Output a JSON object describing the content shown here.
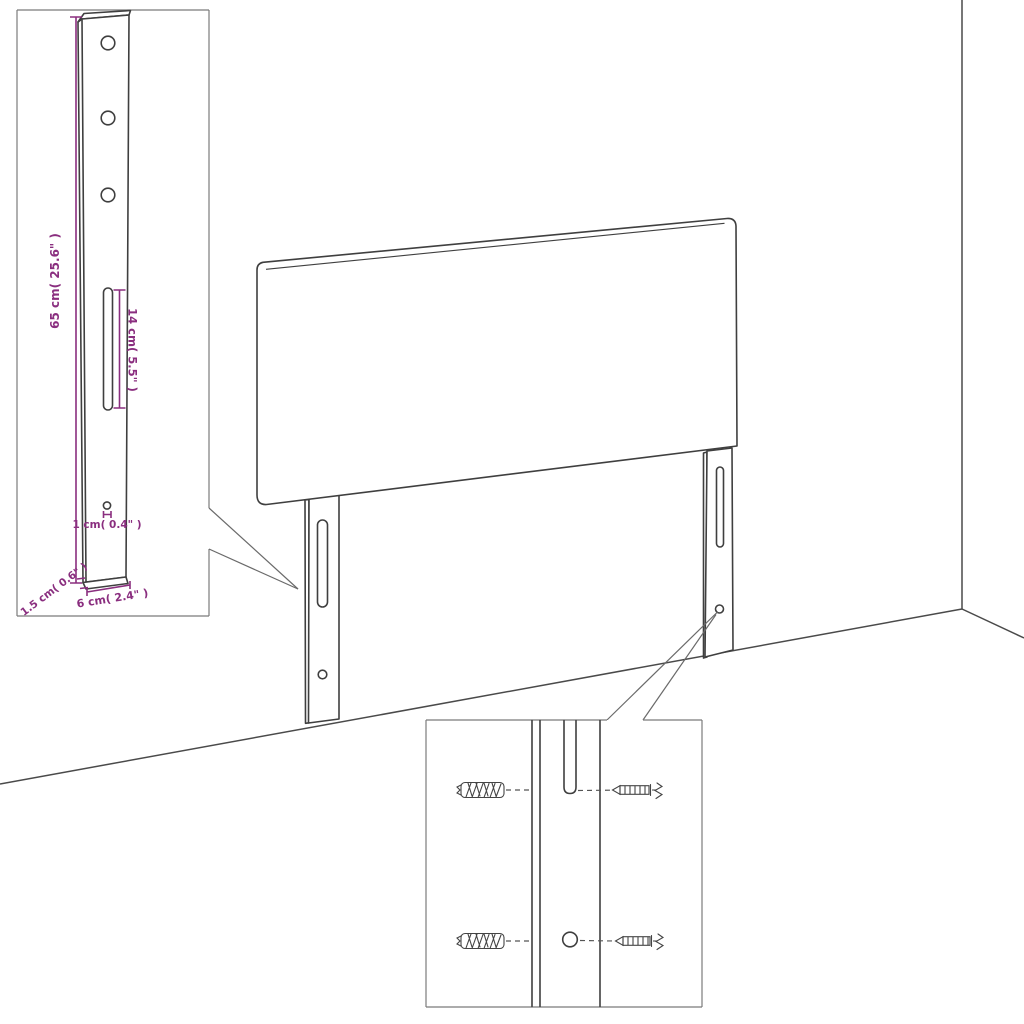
{
  "diagram": {
    "kind": "headboard-assembly-dimension-diagram",
    "labels": {
      "bracket_height": "65 cm( 25.6\" )",
      "slot_length": "14 cm( 5.5\" )",
      "bottom_hole_offset": "1 cm( 0.4\" )",
      "bracket_thickness": "1.5 cm( 0.6\" )",
      "bracket_width": "6 cm( 2.4\" )"
    },
    "colors": {
      "line": "#3f3f3f",
      "dimension": "#8a2e7f",
      "inset_border": "#7b7b7b",
      "leader": "#6a6a6a",
      "background": "#ffffff"
    }
  }
}
